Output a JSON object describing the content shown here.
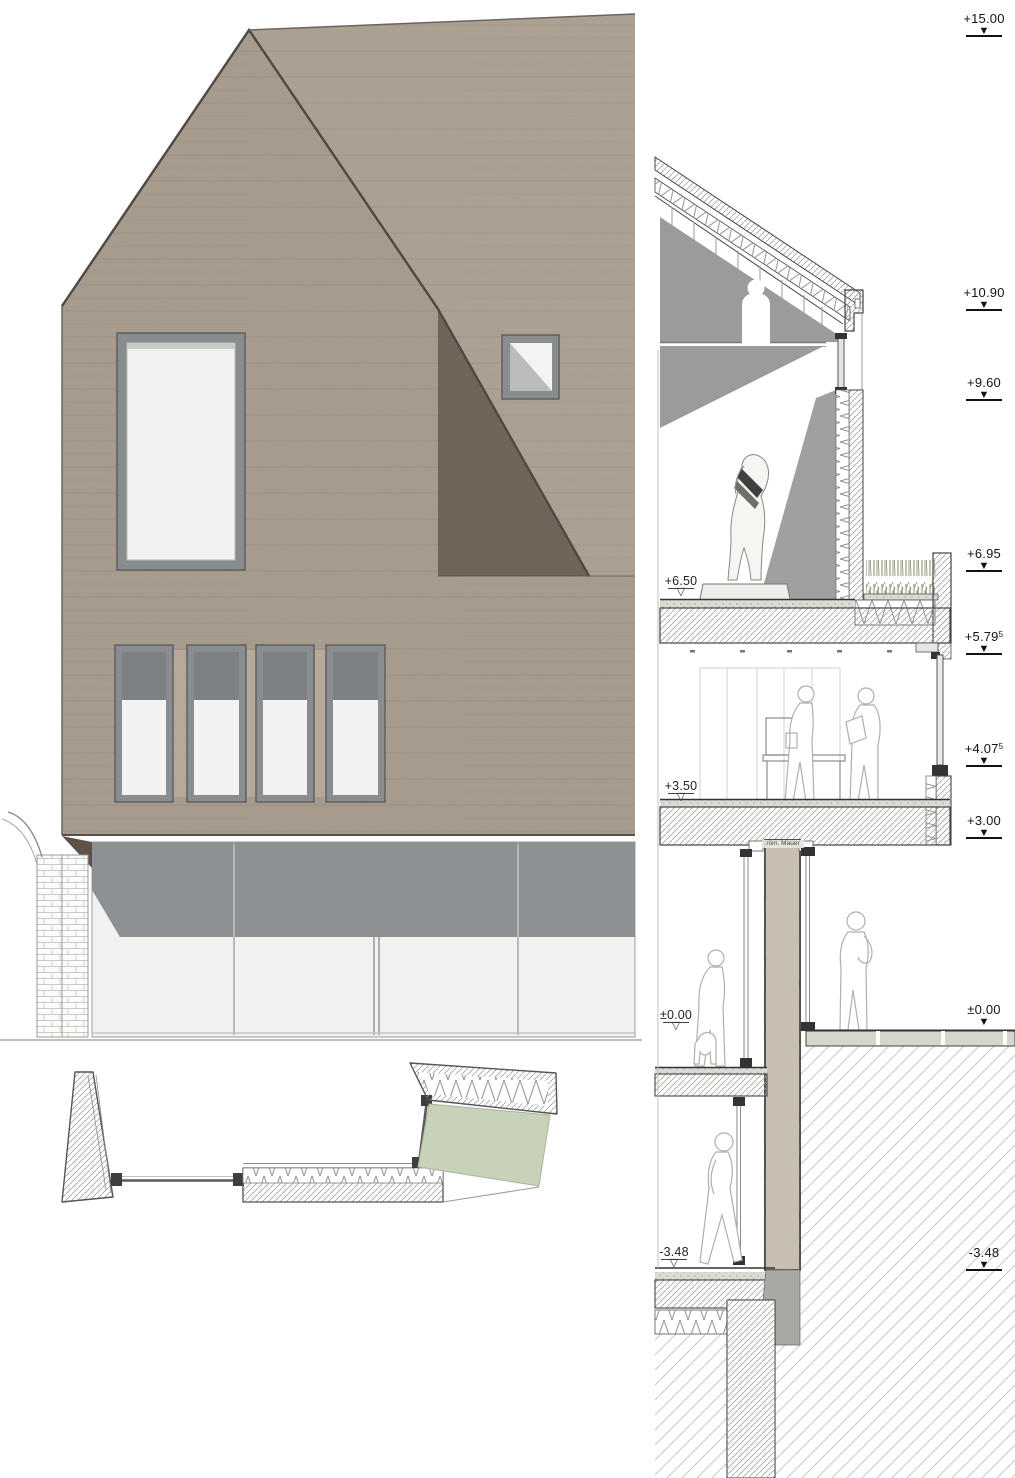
{
  "drawing": {
    "levels_right": [
      {
        "label": "+15.00",
        "sup": ""
      },
      {
        "label": "+10.90",
        "sup": ""
      },
      {
        "label": "+9.60",
        "sup": ""
      },
      {
        "label": "+6.95",
        "sup": ""
      },
      {
        "label": "+5.79",
        "sup": "5"
      },
      {
        "label": "+4.07",
        "sup": "5"
      },
      {
        "label": "+3.00",
        "sup": ""
      },
      {
        "label": "±0.00",
        "sup": ""
      },
      {
        "label": "-3.48",
        "sup": ""
      }
    ],
    "levels_inner": [
      {
        "label": "+6.50"
      },
      {
        "label": "+3.50"
      },
      {
        "label": "±0.00"
      },
      {
        "label": "-3.48"
      }
    ],
    "annotations": {
      "roman_wall": "röm. Mauer"
    },
    "palette": {
      "facade_concrete": "#a79a8c",
      "facade_shadow": "#6a5f53",
      "frame_gray": "#8a8d8f",
      "storefront_gray": "#8d9193",
      "glass_white": "#f1f2f0",
      "interior_shadow": "#9b9b9b",
      "roman_wall": "#c8bfb0",
      "green_roof": "#c8d2ba",
      "plant_green": "#7f8c66",
      "line_dark": "#3a3a3a"
    }
  }
}
